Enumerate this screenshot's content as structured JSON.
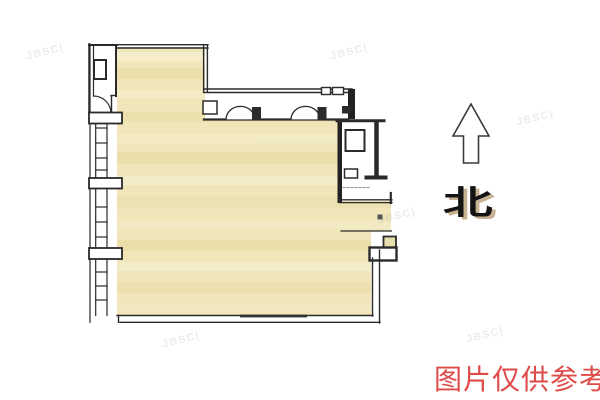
{
  "floorplan": {
    "compass": {
      "label": "北",
      "direction": "north"
    },
    "caption": {
      "text": "图片仅供参考",
      "color": "#de4c4a"
    },
    "watermark": {
      "text": "JBSC|",
      "instances": 6
    },
    "colors": {
      "floor": "#f0e6ba",
      "floor_streak_dark": "#e6d9a0",
      "floor_streak_light": "#f8f1d6",
      "wall": "#2a2a2a",
      "wall_dark": "#222222",
      "caption_red": "#de4c4a",
      "north_text": "#141414",
      "north_shadow": "#9b733c"
    }
  }
}
